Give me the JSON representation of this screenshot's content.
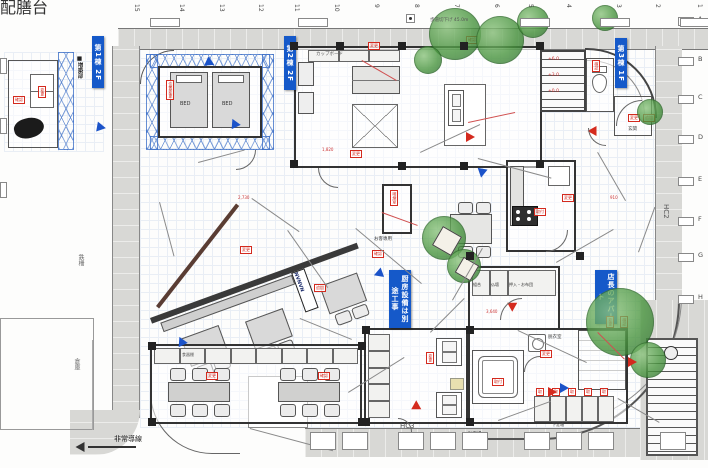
{
  "title": "配置・平面詳細図",
  "colors": {
    "road": "#d8d8d5",
    "wall": "#333333",
    "banner": "#1559c9",
    "stamp": "#d42a1e",
    "truss": "#4072c8",
    "tree": "#49953f"
  },
  "labels": {
    "bed": "BED",
    "cupboard": "カップボード",
    "smoking_note": "お客専用",
    "closet_cells": [
      "組合",
      "仏壇",
      "押入・お布団"
    ],
    "locker_note": "下足箱",
    "genkan": "玄関",
    "dressing": "脱衣室",
    "logo": "NVNVN",
    "emergency": "非常導線",
    "fence": "鉄柵",
    "storage": "倉庫",
    "hc2": "HC2",
    "hc3": "HC3",
    "sidewalk_note": "歩道切下げ 45.0m",
    "bicycle": "自転車",
    "bike": "バイク",
    "parking": "駐車場",
    "annex_note": "■増築部",
    "shelf": "食器棚",
    "serve": "配膳台"
  },
  "banners": [
    {
      "t": "第1棟 2F",
      "x": 92,
      "y": 36,
      "h": 46
    },
    {
      "t": "第2棟 2F",
      "x": 284,
      "y": 36,
      "h": 48
    },
    {
      "t": "第3棟 1F",
      "x": 615,
      "y": 38,
      "h": 44
    },
    {
      "t": "厨房設備は別途工事",
      "x": 389,
      "y": 270,
      "h": 52
    },
    {
      "t": "店長のアパート",
      "x": 595,
      "y": 270,
      "h": 48
    }
  ],
  "stamps": [
    {
      "x": 38,
      "y": 86,
      "v": 1,
      "t": "変更"
    },
    {
      "x": 13,
      "y": 96,
      "v": 0,
      "t": "確認"
    },
    {
      "x": 166,
      "y": 80,
      "v": 1,
      "t": "位置変更"
    },
    {
      "x": 350,
      "y": 150,
      "v": 0,
      "t": "変更"
    },
    {
      "x": 390,
      "y": 190,
      "v": 1,
      "t": "喫煙室"
    },
    {
      "x": 372,
      "y": 250,
      "v": 0,
      "t": "確認"
    },
    {
      "x": 240,
      "y": 246,
      "v": 0,
      "t": "変更"
    },
    {
      "x": 314,
      "y": 284,
      "v": 0,
      "t": "追加"
    },
    {
      "x": 562,
      "y": 194,
      "v": 0,
      "t": "変更"
    },
    {
      "x": 534,
      "y": 208,
      "v": 0,
      "t": "取付"
    },
    {
      "x": 592,
      "y": 60,
      "v": 1,
      "t": "確認"
    },
    {
      "x": 628,
      "y": 114,
      "v": 0,
      "t": "変更"
    },
    {
      "x": 643,
      "y": 114,
      "v": 0,
      "t": "追加"
    },
    {
      "x": 606,
      "y": 316,
      "v": 1,
      "t": "変更"
    },
    {
      "x": 620,
      "y": 316,
      "v": 1,
      "t": "確認"
    },
    {
      "x": 426,
      "y": 352,
      "v": 1,
      "t": "変更"
    },
    {
      "x": 492,
      "y": 378,
      "v": 0,
      "t": "取付"
    },
    {
      "x": 206,
      "y": 372,
      "v": 0,
      "t": "変更"
    },
    {
      "x": 318,
      "y": 372,
      "v": 0,
      "t": "確認"
    },
    {
      "x": 368,
      "y": 42,
      "v": 0,
      "t": "変更"
    },
    {
      "x": 466,
      "y": 36,
      "v": 0,
      "t": "確認"
    },
    {
      "x": 540,
      "y": 350,
      "v": 0,
      "t": "変更"
    },
    {
      "x": 536,
      "y": 388,
      "v": 0,
      "t": "取"
    },
    {
      "x": 552,
      "y": 388,
      "v": 0,
      "t": "取"
    },
    {
      "x": 568,
      "y": 388,
      "v": 0,
      "t": "取"
    },
    {
      "x": 584,
      "y": 388,
      "v": 0,
      "t": "取"
    },
    {
      "x": 600,
      "y": 388,
      "v": 0,
      "t": "取"
    }
  ],
  "trees": [
    {
      "x": 455,
      "y": 34,
      "r": 26
    },
    {
      "x": 500,
      "y": 40,
      "r": 24
    },
    {
      "x": 533,
      "y": 22,
      "r": 16
    },
    {
      "x": 605,
      "y": 18,
      "r": 13
    },
    {
      "x": 444,
      "y": 238,
      "r": 22
    },
    {
      "x": 464,
      "y": 266,
      "r": 17
    },
    {
      "x": 620,
      "y": 322,
      "r": 34
    },
    {
      "x": 648,
      "y": 360,
      "r": 18
    },
    {
      "x": 650,
      "y": 112,
      "r": 13
    },
    {
      "x": 428,
      "y": 60,
      "r": 14
    }
  ],
  "planters": [
    {
      "x": 436,
      "y": 230,
      "s": 20
    },
    {
      "x": 458,
      "y": 260,
      "s": 16
    }
  ],
  "grid_top": {
    "labels": [
      "15",
      "14",
      "13",
      "12",
      "11",
      "10",
      "9",
      "8",
      "7",
      "6",
      "5",
      "4",
      "3",
      "2",
      "1"
    ],
    "xs": [
      133,
      178,
      218,
      257,
      293,
      333,
      373,
      413,
      453,
      493,
      527,
      565,
      615,
      654,
      696
    ]
  },
  "grid_right": {
    "labels": [
      "A",
      "B",
      "C",
      "D",
      "E",
      "F",
      "G",
      "H"
    ],
    "ys": [
      16,
      56,
      94,
      134,
      176,
      216,
      252,
      294
    ]
  },
  "arrows": [
    {
      "x": 206,
      "y": 57,
      "d": 25,
      "c": "blue"
    },
    {
      "x": 233,
      "y": 120,
      "d": -115,
      "c": "blue"
    },
    {
      "x": 97,
      "y": 122,
      "d": 10,
      "c": "blue"
    },
    {
      "x": 480,
      "y": 166,
      "d": 100,
      "c": "blue"
    },
    {
      "x": 560,
      "y": 383,
      "d": 0,
      "c": "blue"
    },
    {
      "x": 180,
      "y": 338,
      "d": -115,
      "c": "blue"
    },
    {
      "x": 378,
      "y": 268,
      "d": 160,
      "c": "blue"
    },
    {
      "x": 592,
      "y": 126,
      "d": 180,
      "c": "red"
    },
    {
      "x": 466,
      "y": 132,
      "d": 0,
      "c": "red"
    },
    {
      "x": 414,
      "y": 402,
      "d": -90,
      "c": "red"
    },
    {
      "x": 548,
      "y": 387,
      "d": 0,
      "c": "red"
    },
    {
      "x": 628,
      "y": 357,
      "d": 0,
      "c": "red"
    },
    {
      "x": 510,
      "y": 300,
      "d": 90,
      "c": "red"
    }
  ],
  "lines": [
    [
      252,
      198,
      58,
      35,
      0
    ],
    [
      420,
      152,
      66,
      -25,
      0
    ],
    [
      478,
      158,
      76,
      15,
      0
    ],
    [
      356,
      228,
      86,
      40,
      0
    ],
    [
      556,
      262,
      66,
      -30,
      0
    ],
    [
      300,
      318,
      56,
      22,
      0
    ],
    [
      430,
      332,
      48,
      -45,
      0
    ],
    [
      518,
      330,
      76,
      25,
      0
    ],
    [
      198,
      162,
      48,
      -15,
      0
    ],
    [
      598,
      152,
      56,
      60,
      0
    ],
    [
      638,
      252,
      48,
      -70,
      0
    ],
    [
      348,
      392,
      66,
      -32,
      0
    ],
    [
      250,
      428,
      86,
      15,
      0
    ],
    [
      498,
      420,
      56,
      -20,
      0
    ],
    [
      160,
      202,
      56,
      75,
      0
    ],
    [
      618,
      398,
      48,
      30,
      0
    ],
    [
      288,
      230,
      70,
      55,
      0
    ],
    [
      452,
      300,
      60,
      -60,
      0
    ],
    [
      382,
      212,
      38,
      20,
      1
    ],
    [
      468,
      122,
      48,
      -12,
      1
    ],
    [
      598,
      332,
      38,
      45,
      1
    ],
    [
      362,
      60,
      40,
      30,
      1
    ]
  ],
  "texts": [
    {
      "x": 662,
      "y": 204,
      "t": "HC2",
      "r": 1,
      "c": "#555",
      "s": 7
    },
    {
      "x": 400,
      "y": 423,
      "t": "HC3",
      "r": 0,
      "c": "#555",
      "s": 7
    },
    {
      "x": 77,
      "y": 254,
      "t": "鉄柵",
      "r": 1,
      "c": "#666",
      "s": 6
    },
    {
      "x": 73,
      "y": 358,
      "t": "倉庫",
      "r": 1,
      "c": "#666",
      "s": 6
    },
    {
      "x": 430,
      "y": 19,
      "t": "歩道切下げ 45.0m",
      "r": 0,
      "c": "#555",
      "s": 4.5
    },
    {
      "x": 316,
      "y": 433,
      "t": "自転車",
      "r": 0,
      "c": "#444",
      "s": 4
    },
    {
      "x": 350,
      "y": 433,
      "t": "バイク",
      "r": 0,
      "c": "#444",
      "s": 4
    },
    {
      "x": 468,
      "y": 433,
      "t": "駐車場",
      "r": 0,
      "c": "#444",
      "s": 4.5
    },
    {
      "x": 322,
      "y": 148,
      "t": "1,820",
      "r": 0,
      "c": "#c33",
      "s": 4
    },
    {
      "x": 610,
      "y": 196,
      "t": "910",
      "r": 0,
      "c": "#c33",
      "s": 4
    },
    {
      "x": 486,
      "y": 310,
      "t": "3,640",
      "r": 0,
      "c": "#c33",
      "s": 4
    },
    {
      "x": 238,
      "y": 196,
      "t": "2,730",
      "r": 0,
      "c": "#c33",
      "s": 4
    },
    {
      "x": 548,
      "y": 58,
      "t": "+6.0",
      "r": 0,
      "c": "#c33",
      "s": 4.5
    },
    {
      "x": 548,
      "y": 74,
      "t": "+3.0",
      "r": 0,
      "c": "#c33",
      "s": 4.5
    },
    {
      "x": 548,
      "y": 90,
      "t": "+0.0",
      "r": 0,
      "c": "#c33",
      "s": 4.5
    },
    {
      "x": 628,
      "y": 128,
      "t": "玄関",
      "r": 0,
      "c": "#444",
      "s": 4.5
    },
    {
      "x": 374,
      "y": 238,
      "t": "お客専用",
      "r": 0,
      "c": "#333",
      "s": 4.5
    },
    {
      "x": 76,
      "y": 56,
      "t": "■増築部",
      "r": 1,
      "c": "#222",
      "s": 5.5
    },
    {
      "x": 548,
      "y": 336,
      "t": "脱衣室",
      "r": 0,
      "c": "#444",
      "s": 4.5
    },
    {
      "x": 552,
      "y": 423,
      "t": "下足箱",
      "r": 0,
      "c": "#555",
      "s": 4
    }
  ],
  "pillars": [
    [
      290,
      42
    ],
    [
      336,
      42
    ],
    [
      398,
      42
    ],
    [
      460,
      42
    ],
    [
      536,
      42
    ],
    [
      290,
      160
    ],
    [
      398,
      162
    ],
    [
      460,
      162
    ],
    [
      536,
      160
    ],
    [
      362,
      326
    ],
    [
      466,
      326
    ],
    [
      362,
      418
    ],
    [
      466,
      418
    ],
    [
      148,
      342
    ],
    [
      358,
      342
    ],
    [
      148,
      418
    ],
    [
      358,
      418
    ],
    [
      466,
      252
    ],
    [
      576,
      252
    ]
  ],
  "stalls": {
    "xs": [
      310,
      342,
      398,
      430,
      462,
      524,
      556,
      588,
      660
    ],
    "y": 432,
    "w": 26,
    "h": 18
  },
  "road_boxes": [
    {
      "x": 150
    },
    {
      "x": 298
    },
    {
      "x": 520
    },
    {
      "x": 600
    },
    {
      "x": 680
    }
  ],
  "door_arcs": [
    {
      "x": 616,
      "y": 100,
      "r": 26,
      "k": "tl"
    },
    {
      "x": 546,
      "y": 230,
      "r": 22,
      "k": "br"
    },
    {
      "x": 500,
      "y": 298,
      "r": 22,
      "k": "tl"
    },
    {
      "x": 524,
      "y": 356,
      "r": 16,
      "k": "tl"
    },
    {
      "x": 318,
      "y": 168,
      "r": 20,
      "k": "bl"
    },
    {
      "x": 398,
      "y": 418,
      "r": 14,
      "k": "tr"
    },
    {
      "x": 588,
      "y": 128,
      "r": 18,
      "k": "bl"
    },
    {
      "x": 236,
      "y": 150,
      "r": 20,
      "k": "br"
    }
  ]
}
